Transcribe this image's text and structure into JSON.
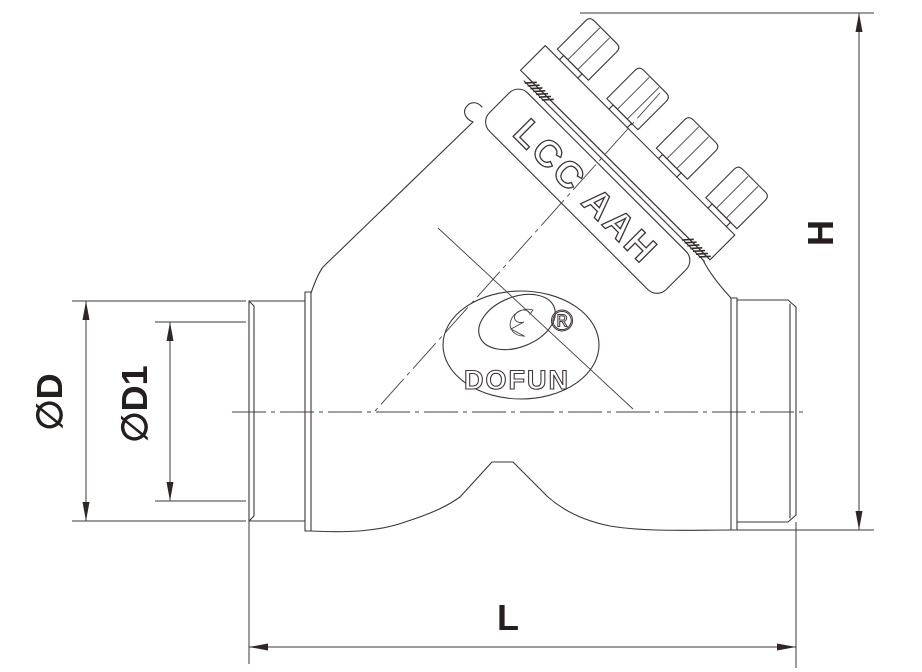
{
  "drawing": {
    "type": "y-pattern-check-valve-technical-drawing",
    "plate_marking": "LCC AAH",
    "logo_text": "DOFUN",
    "registered_symbol": "®",
    "dimensions": {
      "outer_diameter": "∅D",
      "bore_diameter": "∅D1",
      "height": "H",
      "length": "L"
    },
    "colors": {
      "line": "#3f3537",
      "label": "#241e1e",
      "background": "#ffffff"
    }
  }
}
